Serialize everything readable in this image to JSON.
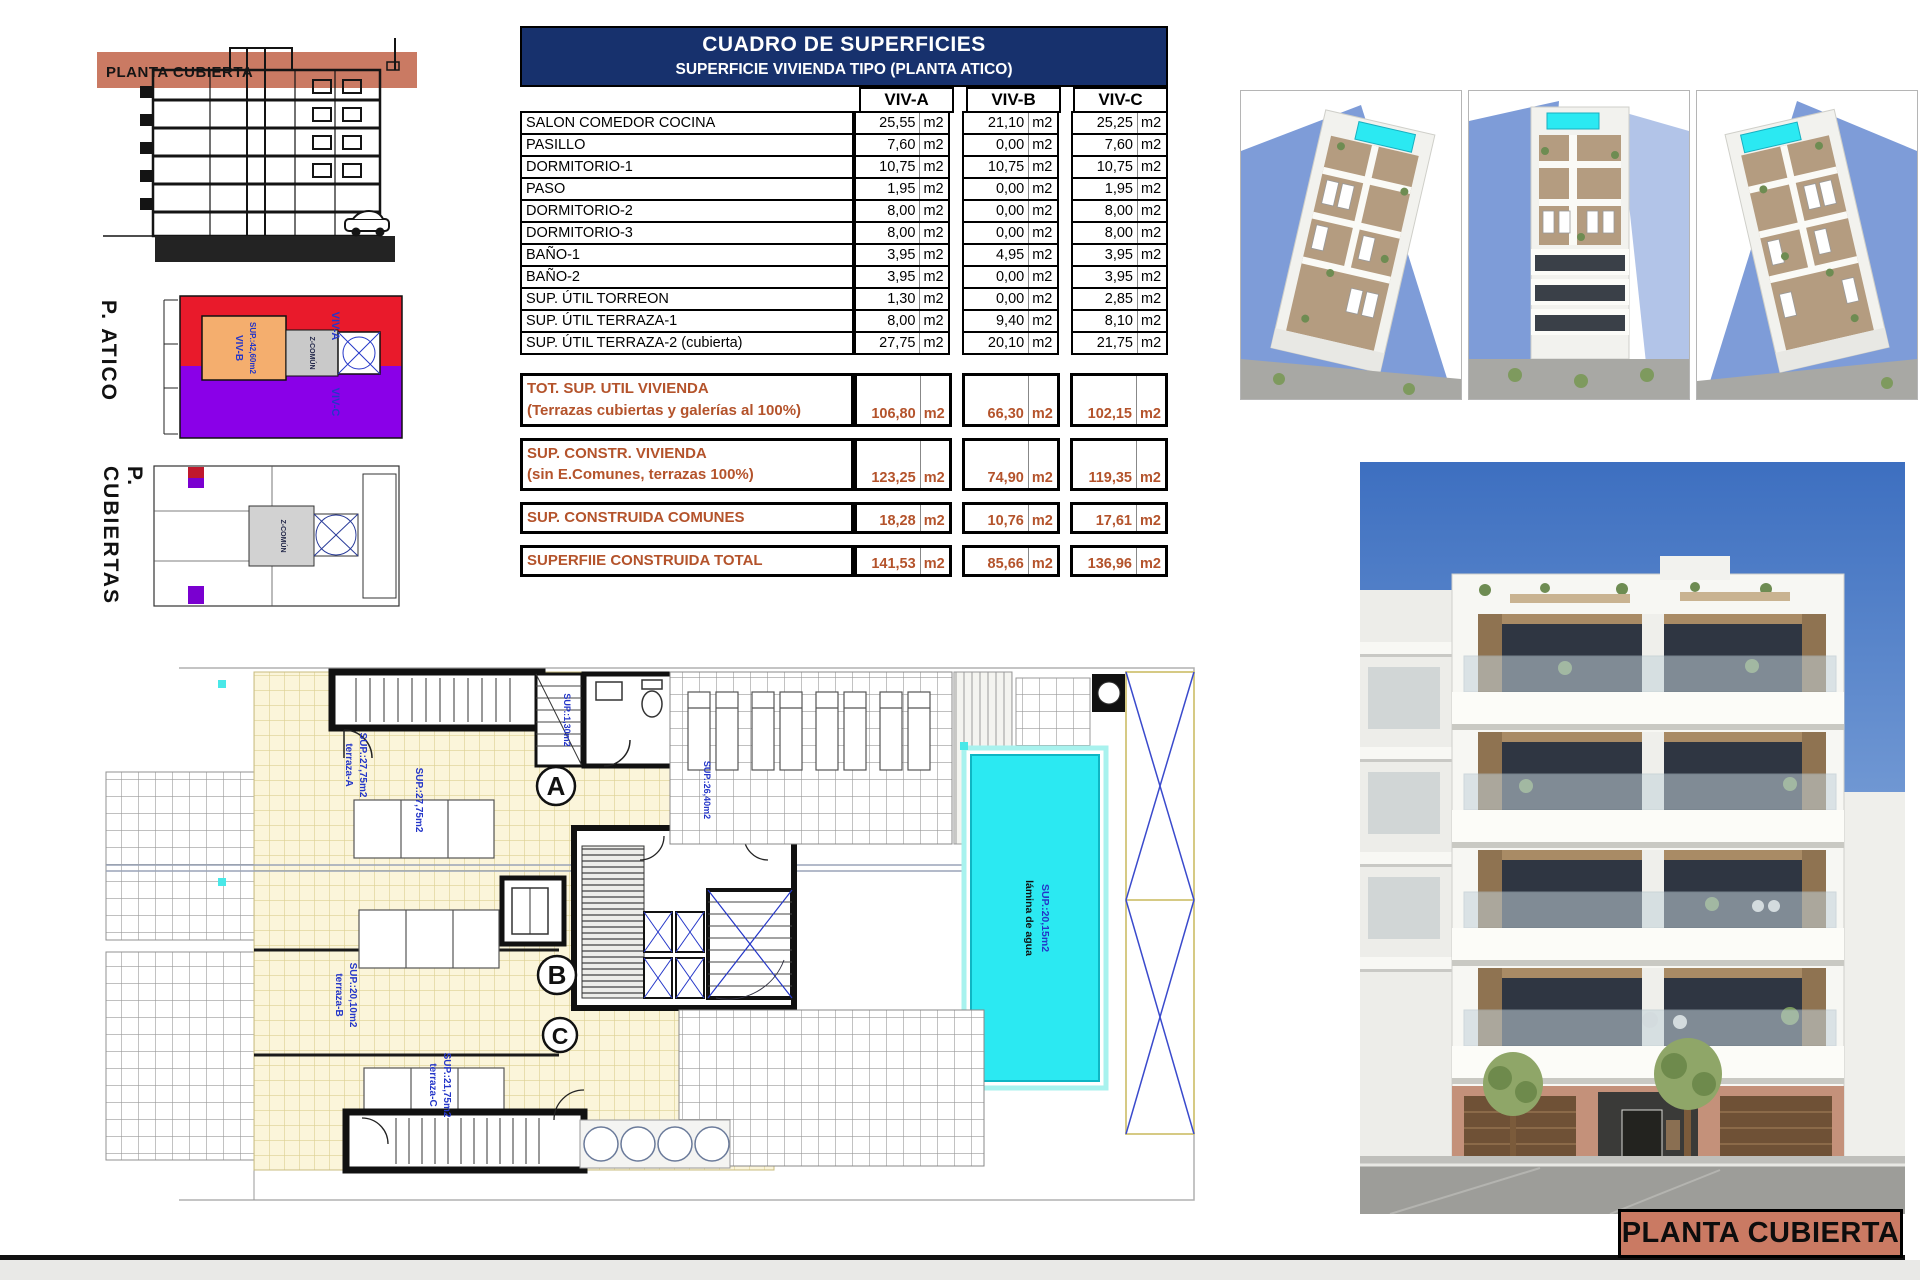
{
  "page": {
    "section_banner": "PLANTA CUBIERTA",
    "title_block": "PLANTA CUBIERTA",
    "atico_label": "P. ATICO",
    "cubiertas_label": "P. CUBIERTAS"
  },
  "table": {
    "title": "CUADRO DE SUPERFICIES",
    "subtitle": "SUPERFICIE VIVIENDA TIPO  (PLANTA ATICO)",
    "columns": [
      "VIV-A",
      "VIV-B",
      "VIV-C"
    ],
    "unit": "m2",
    "rows": [
      {
        "label": "SALON COMEDOR COCINA",
        "values": [
          "25,55",
          "21,10",
          "25,25"
        ]
      },
      {
        "label": "PASILLO",
        "values": [
          "7,60",
          "0,00",
          "7,60"
        ]
      },
      {
        "label": "DORMITORIO-1",
        "values": [
          "10,75",
          "10,75",
          "10,75"
        ]
      },
      {
        "label": "PASO",
        "values": [
          "1,95",
          "0,00",
          "1,95"
        ]
      },
      {
        "label": "DORMITORIO-2",
        "values": [
          "8,00",
          "0,00",
          "8,00"
        ]
      },
      {
        "label": "DORMITORIO-3",
        "values": [
          "8,00",
          "0,00",
          "8,00"
        ]
      },
      {
        "label": "BAÑO-1",
        "values": [
          "3,95",
          "4,95",
          "3,95"
        ]
      },
      {
        "label": "BAÑO-2",
        "values": [
          "3,95",
          "0,00",
          "3,95"
        ]
      },
      {
        "label": "SUP. ÚTIL TORREON",
        "values": [
          "1,30",
          "0,00",
          "2,85"
        ]
      },
      {
        "label": "SUP. ÚTIL TERRAZA-1",
        "values": [
          "8,00",
          "9,40",
          "8,10"
        ]
      },
      {
        "label": "SUP. ÚTIL TERRAZA-2 (cubierta)",
        "values": [
          "27,75",
          "20,10",
          "21,75"
        ]
      }
    ],
    "totals": [
      {
        "label": "TOT. SUP. UTIL VIVIENDA",
        "sublabel": "(Terrazas cubiertas y galerías al 100%)",
        "values": [
          "106,80",
          "66,30",
          "102,15"
        ]
      },
      {
        "label": "SUP. CONSTR. VIVIENDA",
        "sublabel": "(sin E.Comunes, terrazas 100%)",
        "values": [
          "123,25",
          "74,90",
          "119,35"
        ]
      },
      {
        "label": "SUP. CONSTRUIDA COMUNES",
        "sublabel": "",
        "values": [
          "18,28",
          "10,76",
          "17,61"
        ]
      },
      {
        "label": "SUPERFIIE CONSTRUIDA TOTAL",
        "sublabel": "",
        "values": [
          "141,53",
          "85,66",
          "136,96"
        ]
      }
    ]
  },
  "atico_plan": {
    "viv_a": "VIV-A",
    "viv_b": "VIV-B",
    "viv_b_sup": "SUP.:42,60m2",
    "viv_c": "VIV-C",
    "zcomun": "Z-COMÚN"
  },
  "cubiertas_plan": {
    "zcomun": "Z-COMÚN"
  },
  "floor_plan": {
    "terraza_a": "terraza-A",
    "terraza_a_sup": "SUP.:27,75m2",
    "terraza_b": "terraza-B",
    "terraza_b_sup": "SUP.:20,10m2",
    "terraza_c": "terraza-C",
    "terraza_c_sup": "SUP.:21,75m2",
    "solarium_sup": "SUP.:26,40m2",
    "torreon_sup": "SUP.:1,30m2",
    "pool_label": "lámina de agua",
    "pool_sup": "SUP.:20,15m2",
    "letters": [
      "A",
      "B",
      "C"
    ]
  },
  "colors": {
    "navy": "#17316D",
    "totals_text": "#B4532B",
    "salmon": "#CA7A63",
    "red": "#E91A2B",
    "orange": "#F4AE6E",
    "purple": "#8A00E8",
    "pool_cyan": "#2BE9F2",
    "label_blue": "#2436C8"
  }
}
